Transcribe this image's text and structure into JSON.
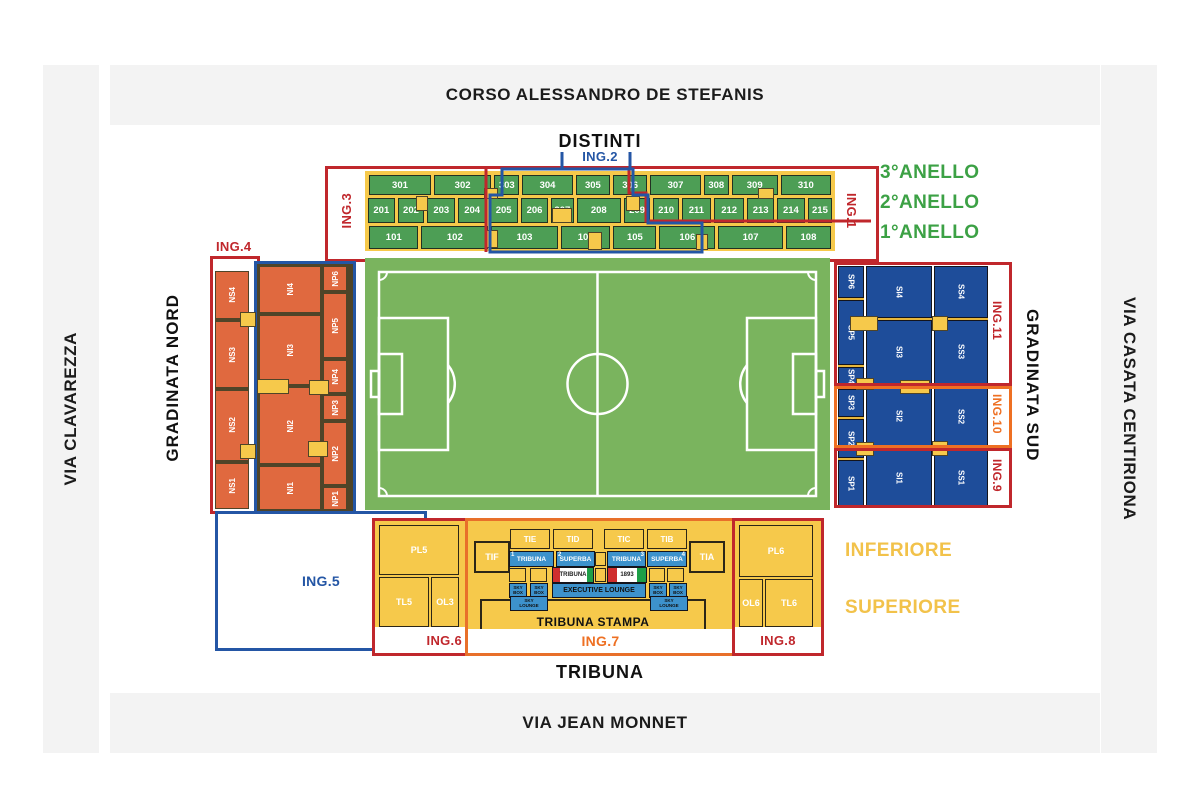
{
  "streets": {
    "top": "CORSO ALESSANDRO DE STEFANIS",
    "bottom": "VIA JEAN MONNET",
    "left": "VIA CLAVAREZZA",
    "right": "VIA CASATA CENTIRIONA"
  },
  "anelli": {
    "a3": "3°ANELLO",
    "a2": "2°ANELLO",
    "a1": "1°ANELLO"
  },
  "distinti": {
    "title": "DISTINTI",
    "ing1": "ING.1",
    "ing2": "ING.2",
    "ing3": "ING.3",
    "row3": [
      "301",
      "302",
      "303",
      "304",
      "305",
      "306",
      "307",
      "308",
      "309",
      "310"
    ],
    "row2": [
      "201",
      "202",
      "203",
      "204",
      "205",
      "206",
      "207",
      "208",
      "209",
      "210",
      "211",
      "212",
      "213",
      "214",
      "215"
    ],
    "row1": [
      "101",
      "102",
      "103",
      "104",
      "105",
      "106",
      "107",
      "108"
    ]
  },
  "nord": {
    "title": "GRADINATA NORD",
    "ing4": "ING.4",
    "ing5": "ING.5",
    "ns": [
      "NS4",
      "NS3",
      "NS2",
      "NS1"
    ],
    "ni": [
      "NI4",
      "NI3",
      "NI2",
      "NI1"
    ],
    "np": [
      "NP6",
      "NP5",
      "NP4",
      "NP3",
      "NP2",
      "NP1"
    ]
  },
  "sud": {
    "title": "GRADINATA SUD",
    "ing11": "ING.11",
    "ing10": "ING.10",
    "ing9": "ING.9",
    "sp": [
      "SP6",
      "SP5",
      "SP4",
      "SP3",
      "SP2",
      "SP1"
    ],
    "si": [
      "SI4",
      "SI3",
      "SI2",
      "SI1"
    ],
    "ss": [
      "SS4",
      "SS3",
      "SS2",
      "SS1"
    ]
  },
  "tribuna": {
    "title": "TRIBUNA",
    "ing6": "ING.6",
    "ing7": "ING.7",
    "ing8": "ING.8",
    "inferiore": "INFERIORE",
    "superiore": "SUPERIORE",
    "left": {
      "pl5": "PL5",
      "tl5": "TL5",
      "ol3": "OL3"
    },
    "right": {
      "pl6": "PL6",
      "ol6": "OL6",
      "tl6": "TL6"
    },
    "tif": "TIF",
    "tia": "TIA",
    "upper": [
      "TIE",
      "TID",
      "TIC",
      "TIB"
    ],
    "boxes": [
      {
        "num": "1",
        "label": "TRIBUNA"
      },
      {
        "num": "2",
        "label": "SUPERBA"
      },
      {
        "num": "3",
        "label": "TRIBUNA"
      },
      {
        "num": "4",
        "label": "SUPERBA"
      }
    ],
    "tricolor": [
      "TRIBUNA",
      "1893"
    ],
    "sky_top": "SKY",
    "skybox_bottom": "BOX",
    "skylounge_bottom": "LOUNGE",
    "executive": "EXECUTIVE LOUNGE",
    "stampa": "TRIBUNA STAMPA"
  },
  "colors": {
    "red": "#c0272c",
    "blue": "#2456a5",
    "orange": "#ee7023",
    "yellow": "#f6c94b",
    "navy_block": "#1e4d9a",
    "orange_block": "#e0693f",
    "green_block": "#4d9e55",
    "field_green": "#7ab45e",
    "band_gray": "#f3f3f3",
    "anello_green": "#3ca145",
    "lounge_blue": "#3d92cc"
  }
}
